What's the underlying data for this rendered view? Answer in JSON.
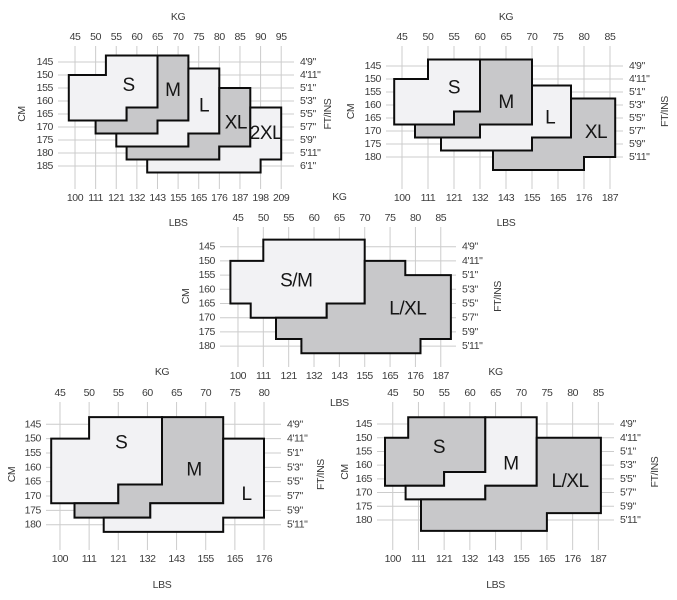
{
  "colors": {
    "light": "#f2f2f4",
    "dark": "#c8c8ca",
    "border": "#0c0c0c",
    "grid": "#cccccc",
    "tick_text": "#3b3b3b",
    "size_text": "#151515"
  },
  "chart_data": [
    {
      "type": "area",
      "position": "top-left",
      "weight_axis": {
        "title_top": "KG",
        "title_bottom": "LBS",
        "kg_ticks": [
          45,
          50,
          55,
          60,
          65,
          70,
          75,
          80,
          85,
          90,
          95
        ],
        "lbs_ticks": [
          100,
          111,
          121,
          132,
          143,
          155,
          165,
          176,
          187,
          198,
          209
        ]
      },
      "height_axis": {
        "title_left": "CM",
        "title_right": "FT/INS",
        "cm_ticks": [
          145,
          150,
          155,
          160,
          165,
          170,
          175,
          180,
          185
        ],
        "ft_ticks": [
          "4'9\"",
          "4'11\"",
          "5'1\"",
          "5'3\"",
          "5'5\"",
          "5'7\"",
          "5'9\"",
          "5'11\"",
          "6'1\""
        ]
      },
      "sizes": [
        {
          "label": "S",
          "shade": "light",
          "label_at_kg_cm": [
            58,
            154
          ],
          "region_kg_cm": [
            [
              52.5,
              142.5
            ],
            [
              65,
              142.5
            ],
            [
              65,
              162.5
            ],
            [
              57.5,
              162.5
            ],
            [
              57.5,
              167.5
            ],
            [
              43.5,
              167.5
            ],
            [
              43.5,
              150
            ],
            [
              52.5,
              150
            ]
          ]
        },
        {
          "label": "M",
          "shade": "dark",
          "label_at_kg_cm": [
            68.7,
            156
          ],
          "region_kg_cm": [
            [
              65,
              142.5
            ],
            [
              72.5,
              142.5
            ],
            [
              72.5,
              167.5
            ],
            [
              65,
              167.5
            ],
            [
              65,
              172.5
            ],
            [
              50,
              172.5
            ],
            [
              50,
              167.5
            ],
            [
              57.5,
              167.5
            ],
            [
              57.5,
              162.5
            ],
            [
              65,
              162.5
            ]
          ]
        },
        {
          "label": "L",
          "shade": "light",
          "label_at_kg_cm": [
            76.3,
            162
          ],
          "region_kg_cm": [
            [
              72.5,
              147.5
            ],
            [
              80,
              147.5
            ],
            [
              80,
              172.5
            ],
            [
              72.5,
              172.5
            ],
            [
              72.5,
              177.5
            ],
            [
              55,
              177.5
            ],
            [
              55,
              172.5
            ],
            [
              65,
              172.5
            ],
            [
              65,
              167.5
            ],
            [
              72.5,
              167.5
            ]
          ]
        },
        {
          "label": "XL",
          "shade": "dark",
          "label_at_kg_cm": [
            84,
            168.5
          ],
          "region_kg_cm": [
            [
              80,
              155
            ],
            [
              87.5,
              155
            ],
            [
              87.5,
              177.5
            ],
            [
              80,
              177.5
            ],
            [
              80,
              182.5
            ],
            [
              57.5,
              182.5
            ],
            [
              57.5,
              177.5
            ],
            [
              72.5,
              177.5
            ],
            [
              72.5,
              172.5
            ],
            [
              80,
              172.5
            ]
          ]
        },
        {
          "label": "2XL",
          "shade": "light",
          "label_at_kg_cm": [
            91.3,
            172.5
          ],
          "region_kg_cm": [
            [
              87.5,
              162.5
            ],
            [
              95,
              162.5
            ],
            [
              95,
              182.5
            ],
            [
              90,
              182.5
            ],
            [
              90,
              187.5
            ],
            [
              62.5,
              187.5
            ],
            [
              62.5,
              182.5
            ],
            [
              80,
              182.5
            ],
            [
              80,
              177.5
            ],
            [
              87.5,
              177.5
            ]
          ]
        }
      ]
    },
    {
      "type": "area",
      "position": "top-right",
      "weight_axis": {
        "title_top": "KG",
        "title_bottom": "LBS",
        "kg_ticks": [
          45,
          50,
          55,
          60,
          65,
          70,
          75,
          80,
          85
        ],
        "lbs_ticks": [
          100,
          111,
          121,
          132,
          143,
          155,
          165,
          176,
          187
        ]
      },
      "height_axis": {
        "title_left": "CM",
        "title_right": "FT/INS",
        "cm_ticks": [
          145,
          150,
          155,
          160,
          165,
          170,
          175,
          180
        ],
        "ft_ticks": [
          "4'9\"",
          "4'11\"",
          "5'1\"",
          "5'3\"",
          "5'5\"",
          "5'7\"",
          "5'9\"",
          "5'11\""
        ]
      },
      "sizes": [
        {
          "label": "S",
          "shade": "light",
          "label_at_kg_cm": [
            55,
            153.5
          ],
          "region_kg_cm": [
            [
              50,
              142.5
            ],
            [
              60,
              142.5
            ],
            [
              60,
              162.5
            ],
            [
              55,
              162.5
            ],
            [
              55,
              167.5
            ],
            [
              43.5,
              167.5
            ],
            [
              43.5,
              150
            ],
            [
              50,
              150
            ]
          ]
        },
        {
          "label": "M",
          "shade": "dark",
          "label_at_kg_cm": [
            65,
            159
          ],
          "region_kg_cm": [
            [
              60,
              142.5
            ],
            [
              70,
              142.5
            ],
            [
              70,
              167.5
            ],
            [
              60,
              167.5
            ],
            [
              60,
              172.5
            ],
            [
              47.5,
              172.5
            ],
            [
              47.5,
              167.5
            ],
            [
              55,
              167.5
            ],
            [
              55,
              162.5
            ],
            [
              60,
              162.5
            ]
          ]
        },
        {
          "label": "L",
          "shade": "light",
          "label_at_kg_cm": [
            73.5,
            165
          ],
          "region_kg_cm": [
            [
              70,
              152.5
            ],
            [
              77.5,
              152.5
            ],
            [
              77.5,
              172.5
            ],
            [
              70,
              172.5
            ],
            [
              70,
              177.5
            ],
            [
              52.5,
              177.5
            ],
            [
              52.5,
              172.5
            ],
            [
              60,
              172.5
            ],
            [
              60,
              167.5
            ],
            [
              70,
              167.5
            ]
          ]
        },
        {
          "label": "XL",
          "shade": "dark",
          "label_at_kg_cm": [
            82.3,
            170.5
          ],
          "region_kg_cm": [
            [
              77.5,
              157.5
            ],
            [
              86,
              157.5
            ],
            [
              86,
              180
            ],
            [
              80,
              180
            ],
            [
              80,
              185
            ],
            [
              62.5,
              185
            ],
            [
              62.5,
              177.5
            ],
            [
              70,
              177.5
            ],
            [
              70,
              172.5
            ],
            [
              77.5,
              172.5
            ]
          ]
        }
      ]
    },
    {
      "type": "area",
      "position": "middle",
      "weight_axis": {
        "title_top": "KG",
        "title_bottom": "LBS",
        "kg_ticks": [
          45,
          50,
          55,
          60,
          65,
          70,
          75,
          80,
          85
        ],
        "lbs_ticks": [
          100,
          111,
          121,
          132,
          143,
          155,
          165,
          176,
          187
        ]
      },
      "height_axis": {
        "title_left": "CM",
        "title_right": "FT/INS",
        "cm_ticks": [
          145,
          150,
          155,
          160,
          165,
          170,
          175,
          180
        ],
        "ft_ticks": [
          "4'9\"",
          "4'11\"",
          "5'1\"",
          "5'3\"",
          "5'5\"",
          "5'7\"",
          "5'9\"",
          "5'11\""
        ]
      },
      "sizes": [
        {
          "label": "S/M",
          "shade": "light",
          "label_at_kg_cm": [
            56.5,
            157
          ],
          "region_kg_cm": [
            [
              50,
              142.5
            ],
            [
              70,
              142.5
            ],
            [
              70,
              165
            ],
            [
              62.5,
              165
            ],
            [
              62.5,
              170
            ],
            [
              47.5,
              170
            ],
            [
              47.5,
              165
            ],
            [
              43.5,
              165
            ],
            [
              43.5,
              150
            ],
            [
              50,
              150
            ]
          ]
        },
        {
          "label": "L/XL",
          "shade": "dark",
          "label_at_kg_cm": [
            78.5,
            167
          ],
          "region_kg_cm": [
            [
              70,
              150
            ],
            [
              78,
              150
            ],
            [
              78,
              155
            ],
            [
              87,
              155
            ],
            [
              87,
              177.5
            ],
            [
              81,
              177.5
            ],
            [
              81,
              182.5
            ],
            [
              57.5,
              182.5
            ],
            [
              57.5,
              177.5
            ],
            [
              52.5,
              177.5
            ],
            [
              52.5,
              170
            ],
            [
              62.5,
              170
            ],
            [
              62.5,
              165
            ],
            [
              70,
              165
            ]
          ]
        }
      ]
    },
    {
      "type": "area",
      "position": "bottom-left",
      "weight_axis": {
        "title_top": "KG",
        "title_bottom": "LBS",
        "kg_ticks": [
          45,
          50,
          55,
          60,
          65,
          70,
          75,
          80
        ],
        "lbs_ticks": [
          100,
          111,
          121,
          132,
          143,
          155,
          165,
          176
        ]
      },
      "height_axis": {
        "title_left": "CM",
        "title_right": "FT/INS",
        "cm_ticks": [
          145,
          150,
          155,
          160,
          165,
          170,
          175,
          180
        ],
        "ft_ticks": [
          "4'9\"",
          "4'11\"",
          "5'1\"",
          "5'3\"",
          "5'5\"",
          "5'7\"",
          "5'9\"",
          "5'11\""
        ]
      },
      "sizes": [
        {
          "label": "S",
          "shade": "light",
          "label_at_kg_cm": [
            55.5,
            151.5
          ],
          "region_kg_cm": [
            [
              50,
              142.5
            ],
            [
              62.5,
              142.5
            ],
            [
              62.5,
              166
            ],
            [
              55,
              166
            ],
            [
              55,
              172.5
            ],
            [
              43.5,
              172.5
            ],
            [
              43.5,
              150
            ],
            [
              50,
              150
            ]
          ]
        },
        {
          "label": "M",
          "shade": "dark",
          "label_at_kg_cm": [
            68,
            161
          ],
          "region_kg_cm": [
            [
              62.5,
              142.5
            ],
            [
              73,
              142.5
            ],
            [
              73,
              172.5
            ],
            [
              60.5,
              172.5
            ],
            [
              60.5,
              177.5
            ],
            [
              47.5,
              177.5
            ],
            [
              47.5,
              172.5
            ],
            [
              55,
              172.5
            ],
            [
              55,
              166
            ],
            [
              62.5,
              166
            ]
          ]
        },
        {
          "label": "L",
          "shade": "light",
          "label_at_kg_cm": [
            77,
            169.5
          ],
          "region_kg_cm": [
            [
              73,
              150
            ],
            [
              80,
              150
            ],
            [
              80,
              177.5
            ],
            [
              73,
              177.5
            ],
            [
              73,
              182.5
            ],
            [
              52.5,
              182.5
            ],
            [
              52.5,
              177.5
            ],
            [
              60.5,
              177.5
            ],
            [
              60.5,
              172.5
            ],
            [
              73,
              172.5
            ]
          ]
        }
      ]
    },
    {
      "type": "area",
      "position": "bottom-right",
      "weight_axis": {
        "title_top": "KG",
        "title_bottom": "LBS",
        "kg_ticks": [
          45,
          50,
          55,
          60,
          65,
          70,
          75,
          80,
          85
        ],
        "lbs_ticks": [
          100,
          111,
          121,
          132,
          143,
          155,
          165,
          176,
          187
        ]
      },
      "height_axis": {
        "title_left": "CM",
        "title_right": "FT/INS",
        "cm_ticks": [
          145,
          150,
          155,
          160,
          165,
          170,
          175,
          180
        ],
        "ft_ticks": [
          "4'9\"",
          "4'11\"",
          "5'1\"",
          "5'3\"",
          "5'5\"",
          "5'7\"",
          "5'9\"",
          "5'11\""
        ]
      },
      "sizes": [
        {
          "label": "S",
          "shade": "dark",
          "label_at_kg_cm": [
            54,
            153.5
          ],
          "region_kg_cm": [
            [
              48,
              142.5
            ],
            [
              63,
              142.5
            ],
            [
              63,
              162.5
            ],
            [
              55,
              162.5
            ],
            [
              55,
              167.5
            ],
            [
              43.5,
              167.5
            ],
            [
              43.5,
              150
            ],
            [
              48,
              150
            ]
          ]
        },
        {
          "label": "M",
          "shade": "light",
          "label_at_kg_cm": [
            68,
            159.5
          ],
          "region_kg_cm": [
            [
              63,
              142.5
            ],
            [
              73,
              142.5
            ],
            [
              73,
              167.5
            ],
            [
              63,
              167.5
            ],
            [
              63,
              172.5
            ],
            [
              47.5,
              172.5
            ],
            [
              47.5,
              167.5
            ],
            [
              55,
              167.5
            ],
            [
              55,
              162.5
            ],
            [
              63,
              162.5
            ]
          ]
        },
        {
          "label": "L/XL",
          "shade": "dark",
          "label_at_kg_cm": [
            79.5,
            166
          ],
          "region_kg_cm": [
            [
              73,
              150
            ],
            [
              85.5,
              150
            ],
            [
              85.5,
              177.5
            ],
            [
              75,
              177.5
            ],
            [
              75,
              184
            ],
            [
              50.5,
              184
            ],
            [
              50.5,
              172.5
            ],
            [
              63,
              172.5
            ],
            [
              63,
              167.5
            ],
            [
              73,
              167.5
            ]
          ]
        }
      ]
    }
  ]
}
